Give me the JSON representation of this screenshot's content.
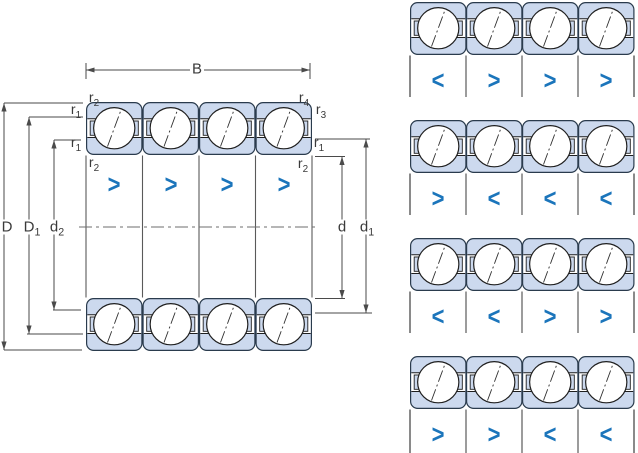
{
  "colors": {
    "background": "#ffffff",
    "bearing_fill": "#ccd9ee",
    "bearing_stroke": "#2a3b4d",
    "line_dark": "#1f1f1f",
    "dim_line": "#4a4a4a",
    "label_text": "#3a3a3a",
    "chevron": "#1b75bb"
  },
  "main_diagram": {
    "width_label": {
      "base": "B",
      "sub": ""
    },
    "radius_labels": {
      "top_left_outer": {
        "base": "r",
        "sub": "2"
      },
      "top_left_inner": {
        "base": "r",
        "sub": "1"
      },
      "top_right_outer": {
        "base": "r",
        "sub": "4"
      },
      "top_right_inner": {
        "base": "r",
        "sub": "3"
      },
      "mid_left_upper": {
        "base": "r",
        "sub": "1"
      },
      "mid_left_lower": {
        "base": "r",
        "sub": "2"
      },
      "mid_right_upper": {
        "base": "r",
        "sub": "1"
      },
      "mid_right_lower": {
        "base": "r",
        "sub": "2"
      }
    },
    "diameter_labels": {
      "outer": {
        "base": "D",
        "sub": ""
      },
      "outer_shoulder": {
        "base": "D",
        "sub": "1"
      },
      "inner_shoulder_left": {
        "base": "d",
        "sub": "2"
      },
      "bore": {
        "base": "d",
        "sub": ""
      },
      "inner_shoulder_right": {
        "base": "d",
        "sub": "1"
      }
    },
    "contact_angle_chevrons": [
      ">",
      ">",
      ">",
      ">"
    ]
  },
  "arrangement_rows": [
    {
      "chevrons": [
        "<",
        ">",
        ">",
        ">"
      ]
    },
    {
      "chevrons": [
        ">",
        "<",
        "<",
        "<"
      ]
    },
    {
      "chevrons": [
        "<",
        "<",
        ">",
        ">"
      ]
    },
    {
      "chevrons": [
        ">",
        ">",
        "<",
        "<"
      ]
    }
  ]
}
